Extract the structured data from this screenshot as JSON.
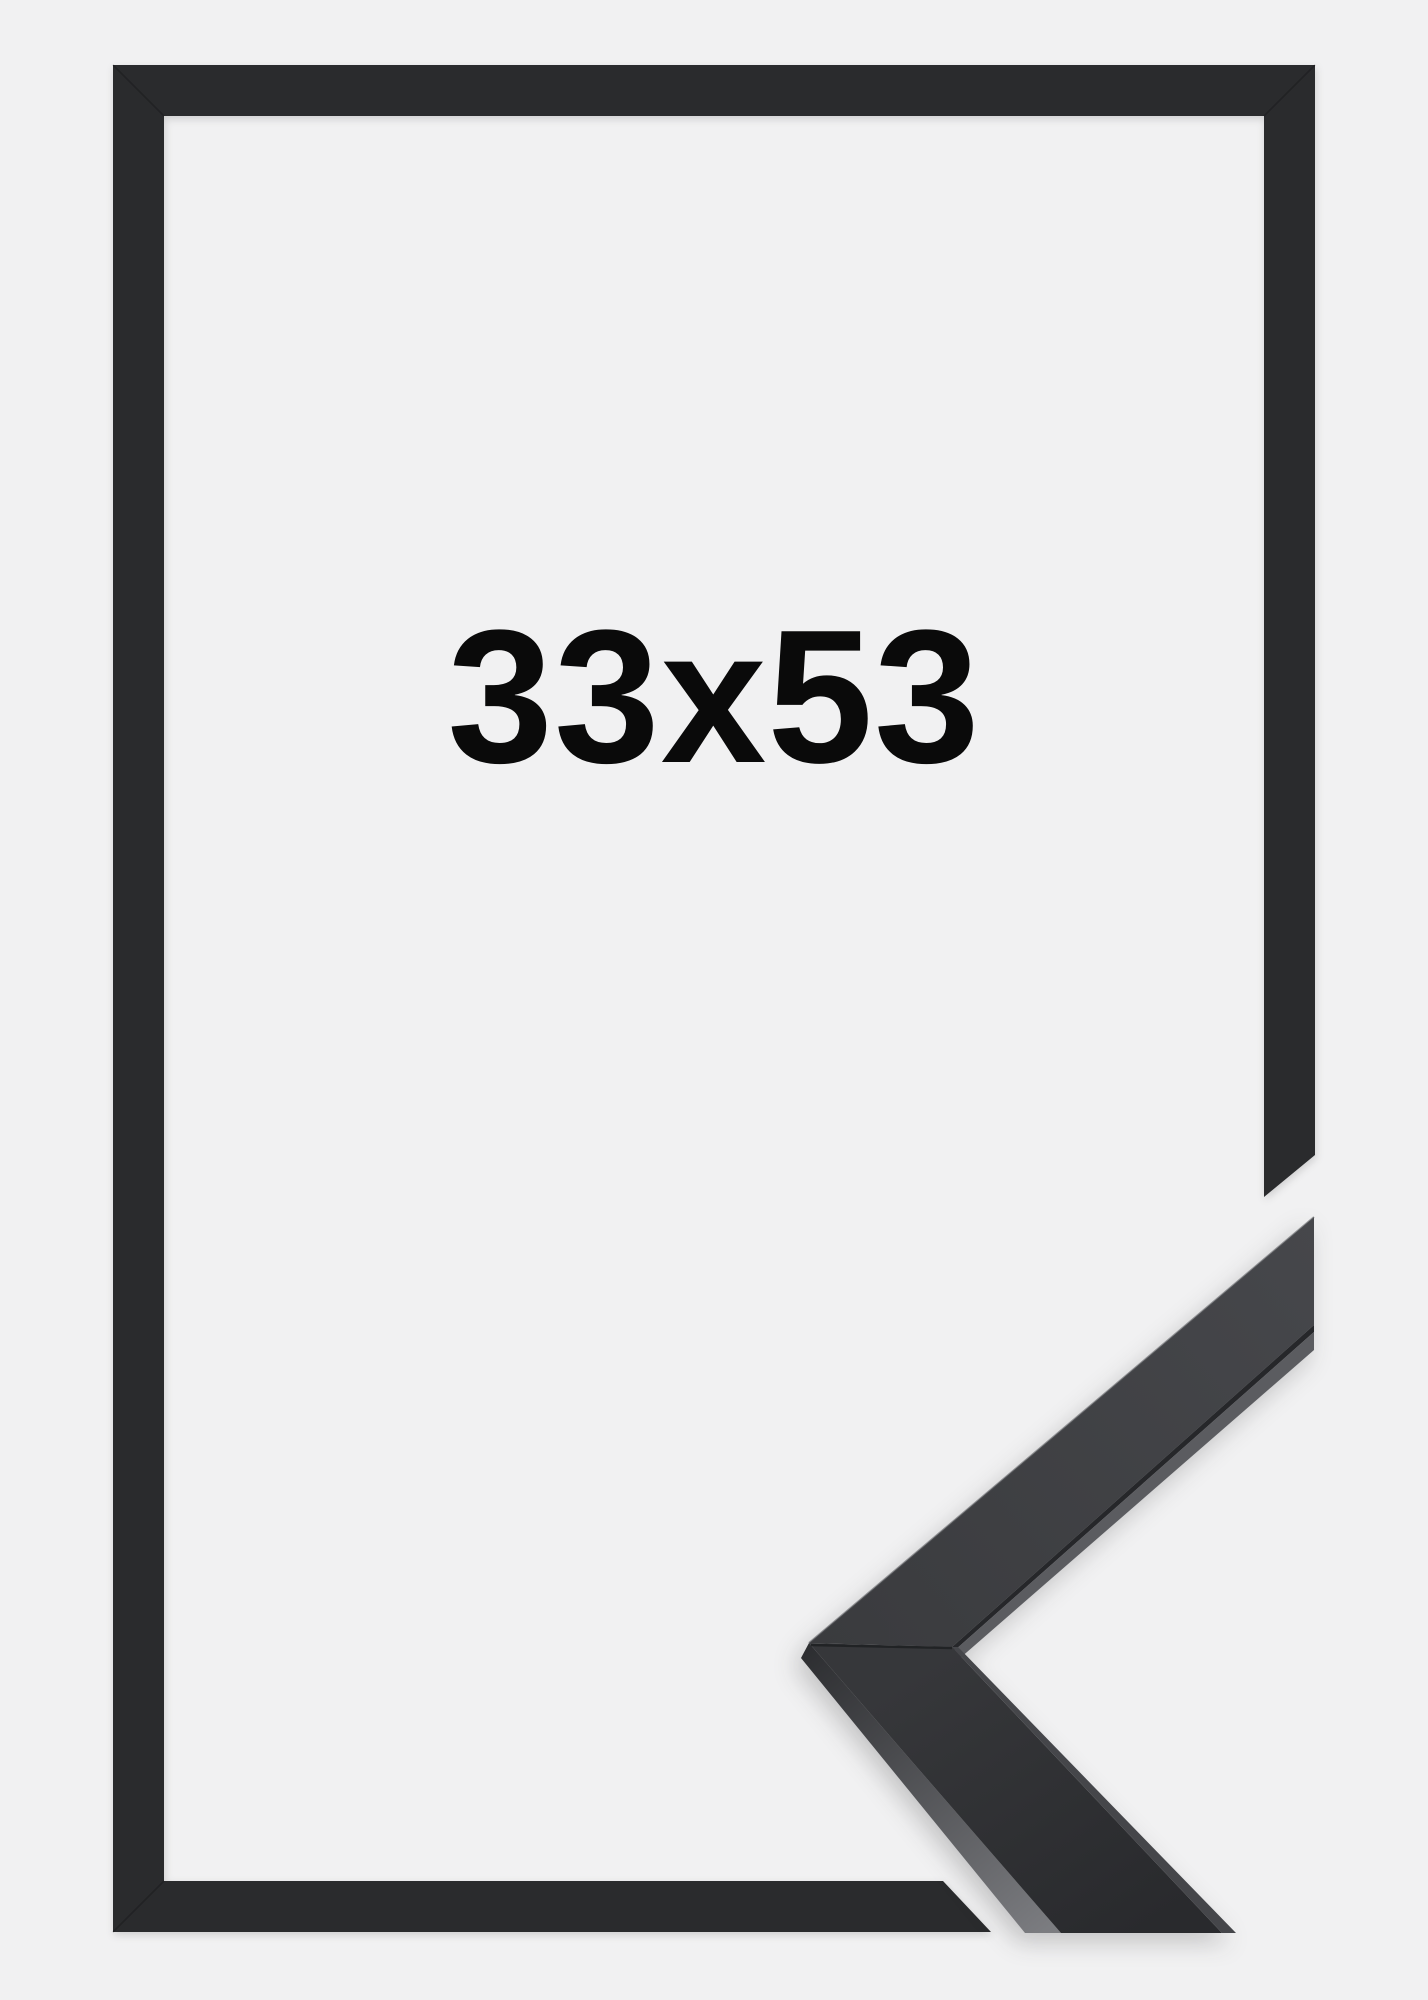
{
  "image": {
    "size_label": "33x53",
    "colors": {
      "background": "#f1f1f2",
      "frame": "#2a2b2d",
      "label": "#0a0a0a",
      "sample_face_top_light": "#46474b",
      "sample_face_top_dark": "#3a3b3e",
      "sample_seam": "#26272a",
      "sample_lip_highlight": "#5b5c60",
      "sample_lip_lower": "#45464a",
      "sample_side_top": "#2c2d30",
      "sample_side_bottom": "#7b7c80",
      "sample_face_lower_top": "#36373a",
      "sample_face_lower_bottom": "#292a2d"
    }
  }
}
